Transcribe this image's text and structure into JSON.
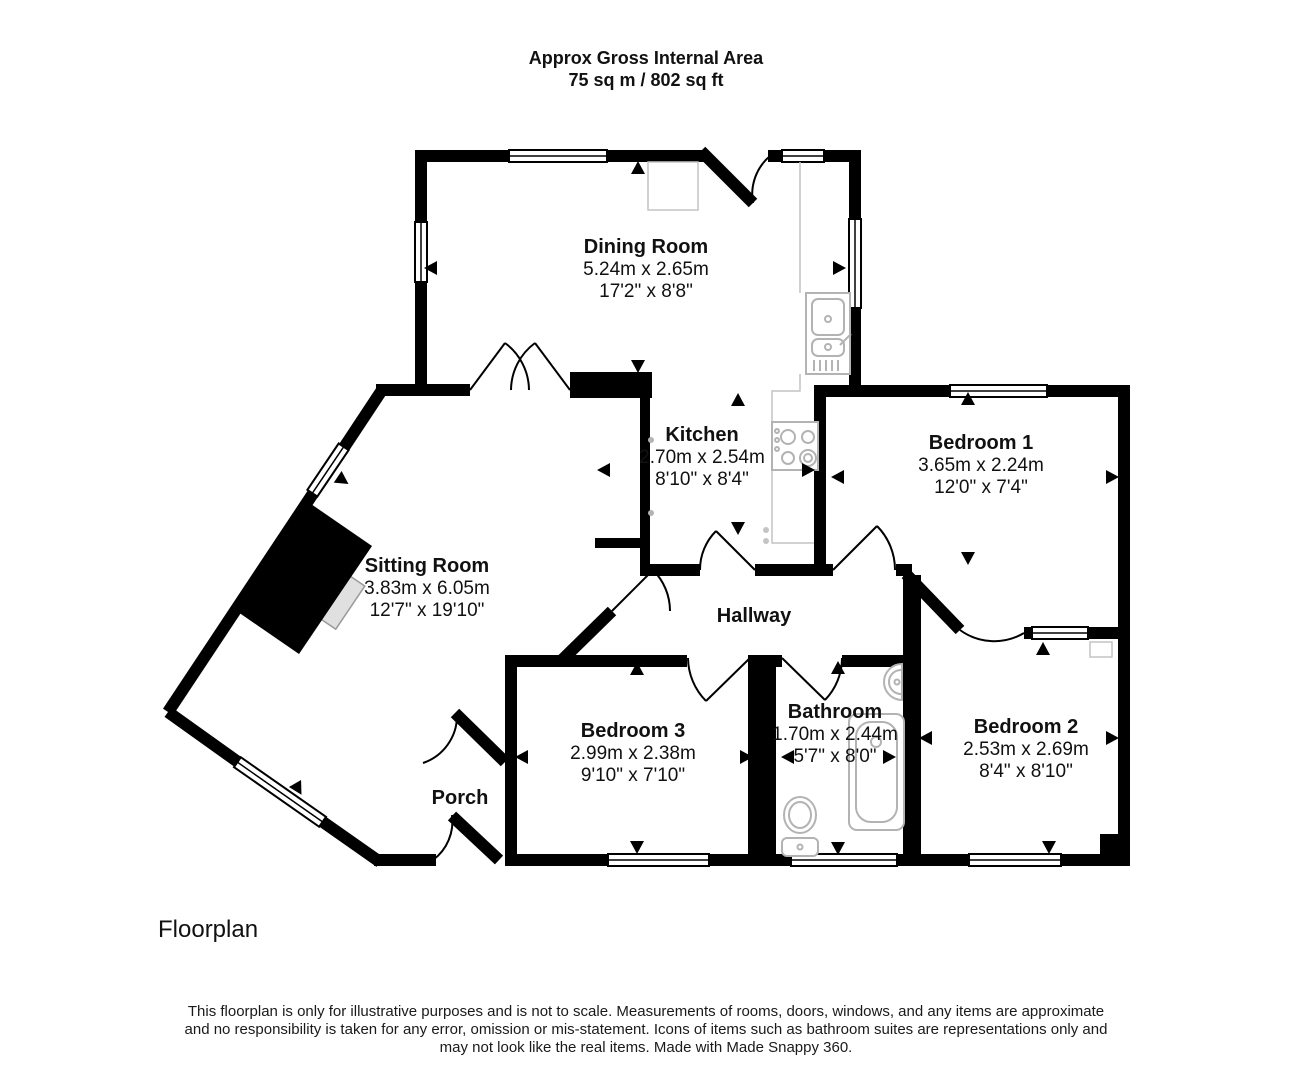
{
  "header": {
    "line1": "Approx Gross Internal Area",
    "line2": "75 sq m / 802 sq ft"
  },
  "rooms": [
    {
      "name": "Dining Room",
      "metric": "5.24m x 2.65m",
      "imperial": "17'2\" x 8'8\""
    },
    {
      "name": "Kitchen",
      "metric": "2.70m x 2.54m",
      "imperial": "8'10\" x 8'4\""
    },
    {
      "name": "Bedroom 1",
      "metric": "3.65m x 2.24m",
      "imperial": "12'0\" x 7'4\""
    },
    {
      "name": "Sitting Room",
      "metric": "3.83m x 6.05m",
      "imperial": "12'7\" x 19'10\""
    },
    {
      "name": "Hallway",
      "metric": "",
      "imperial": ""
    },
    {
      "name": "Bedroom 3",
      "metric": "2.99m x 2.38m",
      "imperial": "9'10\" x 7'10\""
    },
    {
      "name": "Bathroom",
      "metric": "1.70m x 2.44m",
      "imperial": "5'7\" x 8'0\""
    },
    {
      "name": "Bedroom 2",
      "metric": "2.53m x 2.69m",
      "imperial": "8'4\" x 8'10\""
    },
    {
      "name": "Porch",
      "metric": "",
      "imperial": ""
    }
  ],
  "footer": {
    "caption": "Floorplan",
    "disclaimer_lines": [
      "This floorplan is only for illustrative purposes and is not to scale. Measurements of rooms, doors, windows, and any items are approximate",
      "and no responsibility is taken for any error, omission or mis-statement. Icons of items such as bathroom suites are representations only and",
      "may not look like the real items. Made with Made Snappy 360."
    ]
  },
  "icons": [
    "kitchen-sink",
    "hob",
    "fridge",
    "bath",
    "toilet",
    "basin",
    "fireplace",
    "radiator"
  ],
  "colors": {
    "wall": "#000000",
    "fixture_outline": "#b3b3b3",
    "background": "#ffffff"
  }
}
